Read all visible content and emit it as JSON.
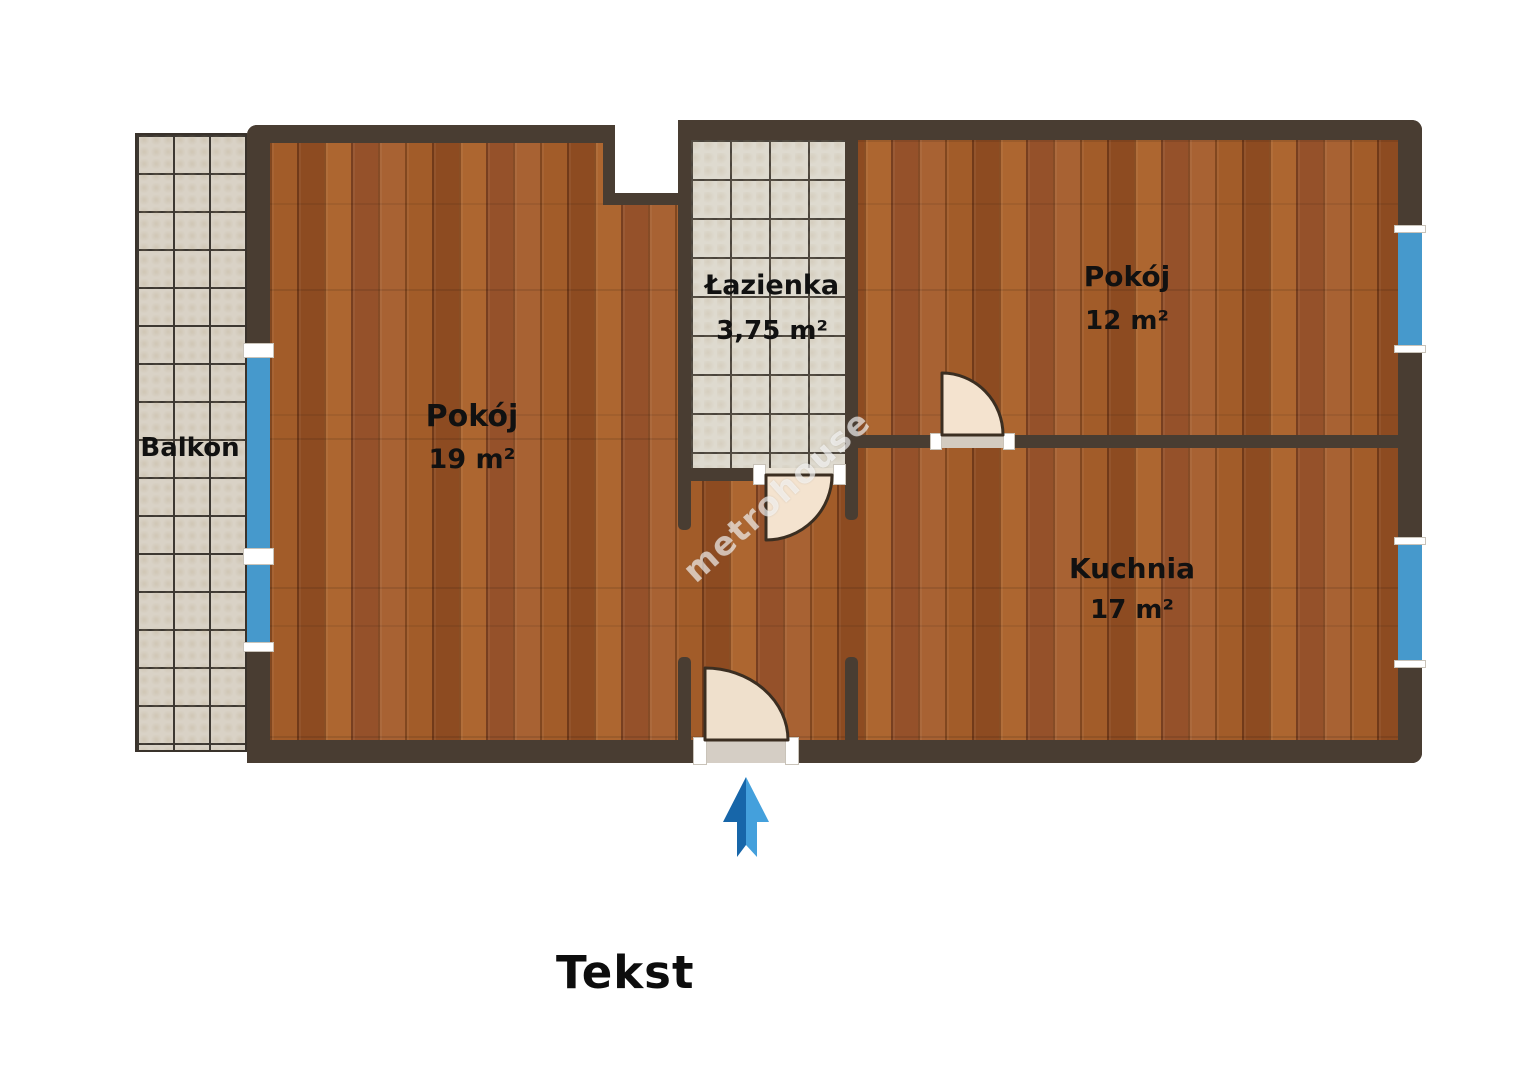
{
  "watermark": "metrohouse",
  "caption": "Tekst",
  "rooms": {
    "pokoj19": {
      "name": "Pokój",
      "area": "19 m²"
    },
    "lazienka": {
      "name": "Łazienka",
      "area": "3,75 m²"
    },
    "pokoj12": {
      "name": "Pokój",
      "area": "12 m²"
    },
    "kuchnia": {
      "name": "Kuchnia",
      "area": "17 m²"
    },
    "balkon": {
      "name": "Balkon"
    }
  },
  "colors": {
    "wall": "#493d32",
    "window": "#4699cc",
    "door": "#f4e3cf",
    "door-outline": "#3b2e21",
    "text": "#111111"
  }
}
